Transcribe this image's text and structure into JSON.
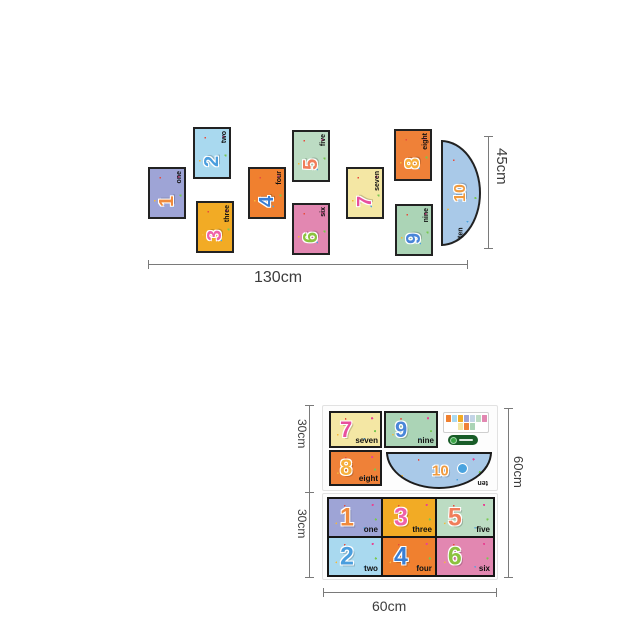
{
  "product": {
    "cards": [
      {
        "digit": "1",
        "label": "one",
        "bg": "#9ea4d6",
        "digit_color": "#f08a3c"
      },
      {
        "digit": "2",
        "label": "two",
        "bg": "#a9d9ef",
        "digit_color": "#4a9ede"
      },
      {
        "digit": "3",
        "label": "three",
        "bg": "#f2ab25",
        "digit_color": "#ef62a8"
      },
      {
        "digit": "4",
        "label": "four",
        "bg": "#f0802f",
        "digit_color": "#3b7fd4"
      },
      {
        "digit": "5",
        "label": "five",
        "bg": "#bcdcc3",
        "digit_color": "#f07d5a"
      },
      {
        "digit": "6",
        "label": "six",
        "bg": "#e287b1",
        "digit_color": "#8cc23f"
      },
      {
        "digit": "7",
        "label": "seven",
        "bg": "#f4e7a4",
        "digit_color": "#e8509e"
      },
      {
        "digit": "8",
        "label": "eight",
        "bg": "#ef8138",
        "digit_color": "#f7b03c"
      },
      {
        "digit": "9",
        "label": "nine",
        "bg": "#abd4b6",
        "digit_color": "#4a86d8"
      },
      {
        "digit": "10",
        "label": "ten",
        "bg": "#a9c9e8",
        "digit_color": "#f09a3e"
      }
    ],
    "dimensions": {
      "spread_width": "130cm",
      "spread_height": "45cm",
      "sheet_width": "60cm",
      "sheet_height": "60cm",
      "sheet_half_top": "30cm",
      "sheet_half_bottom": "30cm"
    },
    "badge_color": "#185c28"
  }
}
